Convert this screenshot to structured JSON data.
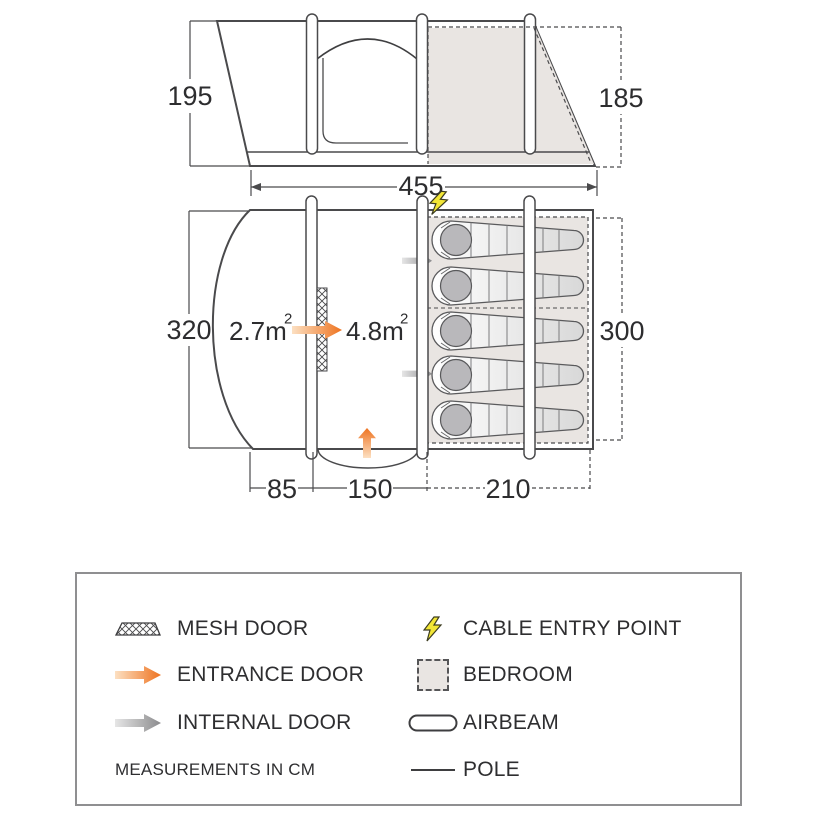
{
  "colors": {
    "line": "#4a4a4c",
    "accent_orange": "#ee7320",
    "internal_grey": "#8b8b8d",
    "bedroom_fill": "#e9e5e2",
    "cable_yellow": "#f2e636",
    "bag_head_grey": "#b9b8bb"
  },
  "side_view": {
    "height_left_cm": "195",
    "height_right_cm": "185",
    "width_cm": "455"
  },
  "floorplan": {
    "depth_left_cm": "320",
    "bedroom_depth_cm": "300",
    "porch_width_cm": "85",
    "living_width_cm": "150",
    "bedroom_width_cm": "210",
    "living_area": {
      "base": "2.7m",
      "sup": "2"
    },
    "bedroom_area": {
      "base": "4.8m",
      "sup": "2"
    },
    "berths": 5
  },
  "legend": {
    "items_left": [
      {
        "icon": "mesh-door-icon",
        "label": "MESH DOOR"
      },
      {
        "icon": "entrance-door-icon",
        "label": "ENTRANCE DOOR"
      },
      {
        "icon": "internal-door-icon",
        "label": "INTERNAL DOOR"
      }
    ],
    "note": "MEASUREMENTS IN CM",
    "items_right": [
      {
        "icon": "cable-entry-point-icon",
        "label": "CABLE ENTRY POINT"
      },
      {
        "icon": "bedroom-icon",
        "label": "BEDROOM"
      },
      {
        "icon": "airbeam-icon",
        "label": "AIRBEAM"
      },
      {
        "icon": "pole-icon",
        "label": "POLE"
      }
    ]
  }
}
